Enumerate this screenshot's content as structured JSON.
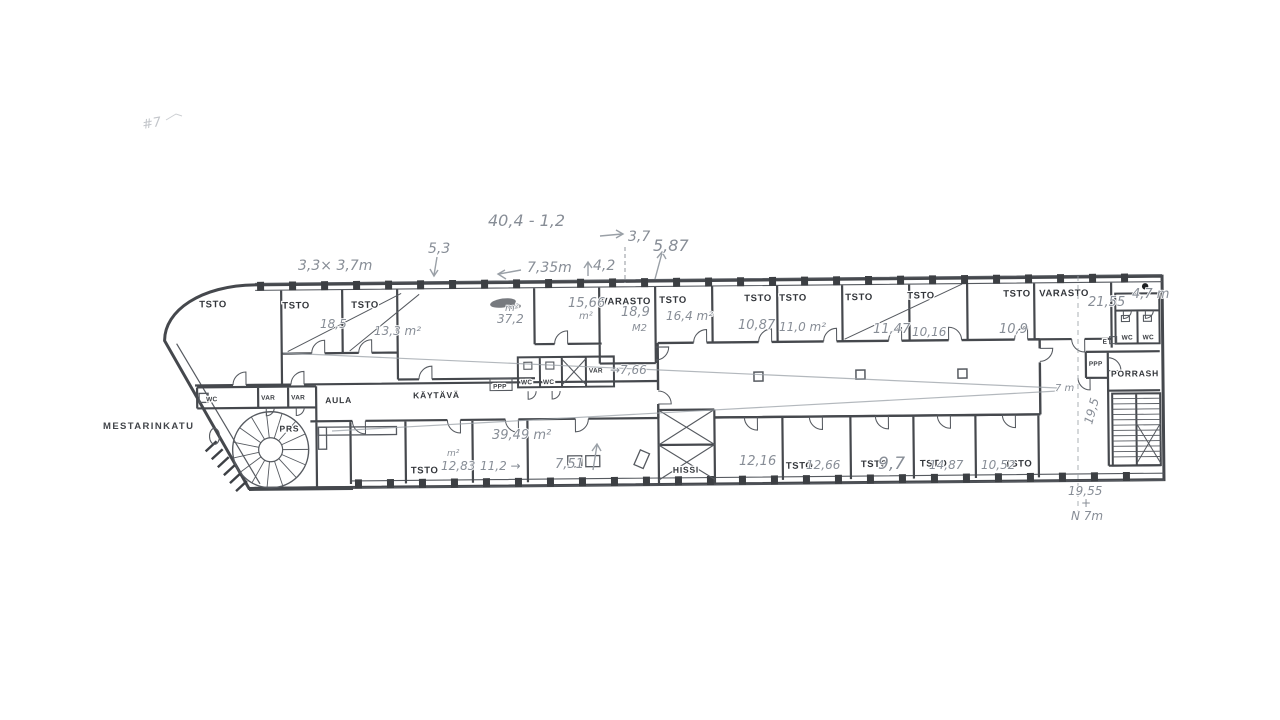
{
  "street": "MESTARINKATU",
  "printed": {
    "tsto": "TSTO",
    "varasto": "VARASTO",
    "wc": "WC",
    "var": "VAR",
    "aula": "AULA",
    "kaytava": "KÄYTÄVÄ",
    "prs": "PRS",
    "hissi": "HISSI",
    "porrash": "PORRASH",
    "ppp": "PPP",
    "e": "E"
  },
  "pencil": {
    "dim_3_3x3_7": "3,3× 3,7m",
    "dim_5_3": "5,3",
    "dim_40_4": "40,4 - 1,2",
    "dim_7_35": "7,35m",
    "dim_4_2": "4,2",
    "dim_3_7": "3,7",
    "dim_5_87": "5,87",
    "area_18_5": "18,5",
    "area_13_3": "13,3 m²",
    "area_37_2_unit": "m²",
    "area_37_2": "37,2",
    "area_15_66": "15,66",
    "area_15_66_unit": "m²",
    "area_18_9": "18,9",
    "area_18_9_unit": "M2",
    "area_16_4": "16,4 m²",
    "area_10_87": "10,87",
    "area_11_0": "11,0 m²",
    "area_11_47": "11,47",
    "area_10_16": "10,16",
    "area_10_9": "10,9",
    "dim_21_55": "21,55",
    "dim_4_7": "4,7 m",
    "dim_7_66": "→7,66",
    "dim_7m": "7 m",
    "dim_19_5": "19,5",
    "area_12_83": "12,83",
    "area_12_83_unit": "m²",
    "area_11_2": "11,2 →",
    "area_39_49": "39,49 m²",
    "area_7_51": "7,51",
    "area_12_16": "12,16",
    "area_12_66": "12,66",
    "area_9_7": "9,7",
    "area_14_87": "14,87",
    "area_10_52": "10,52",
    "dim_19_55": "19,55",
    "dim_plus": "+",
    "dim_n_7m": "N 7m",
    "corner_scribble": "#7"
  }
}
